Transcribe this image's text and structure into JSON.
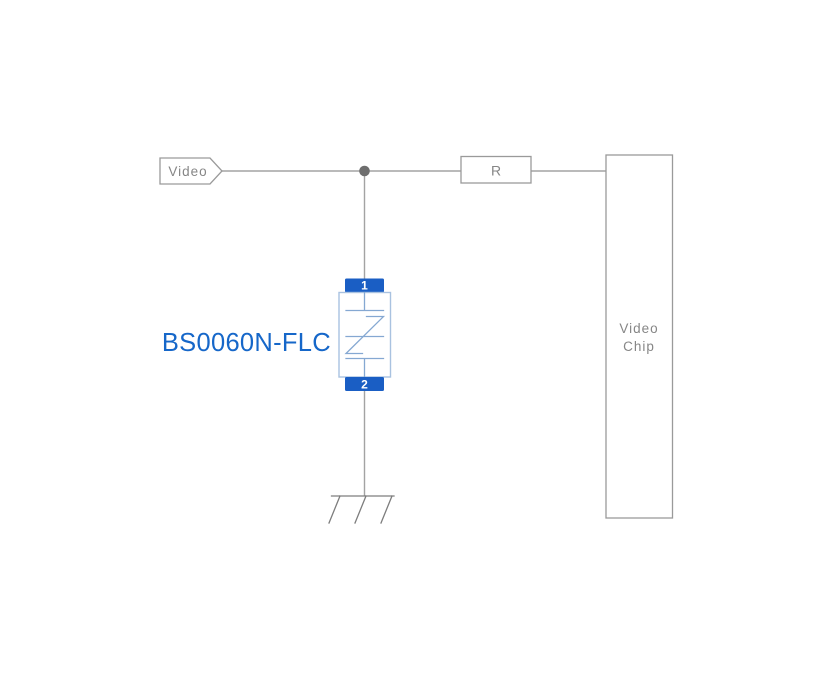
{
  "diagram": {
    "type": "application-circuit-schematic",
    "signal_tag": {
      "label": "Video"
    },
    "resistor": {
      "label": "R"
    },
    "chip": {
      "label_line1": "Video",
      "label_line2": "Chip"
    },
    "tvs_device": {
      "part_number": "BS0060N-FLC",
      "pin_top": "1",
      "pin_bottom": "2"
    }
  },
  "colors": {
    "background": "#ffffff",
    "wire_gray": "#a3a3a3",
    "outline_gray": "#9a9a9a",
    "text_gray": "#868686",
    "junction_dot": "#6e6e6e",
    "pin_blue": "#1a5ec4",
    "pin_number_white": "#ffffff",
    "body_border_blue": "#a9c2e0",
    "symbol_blue": "#85a8d2",
    "part_label_blue": "#1667c9",
    "ground_gray": "#7d7d7d"
  }
}
